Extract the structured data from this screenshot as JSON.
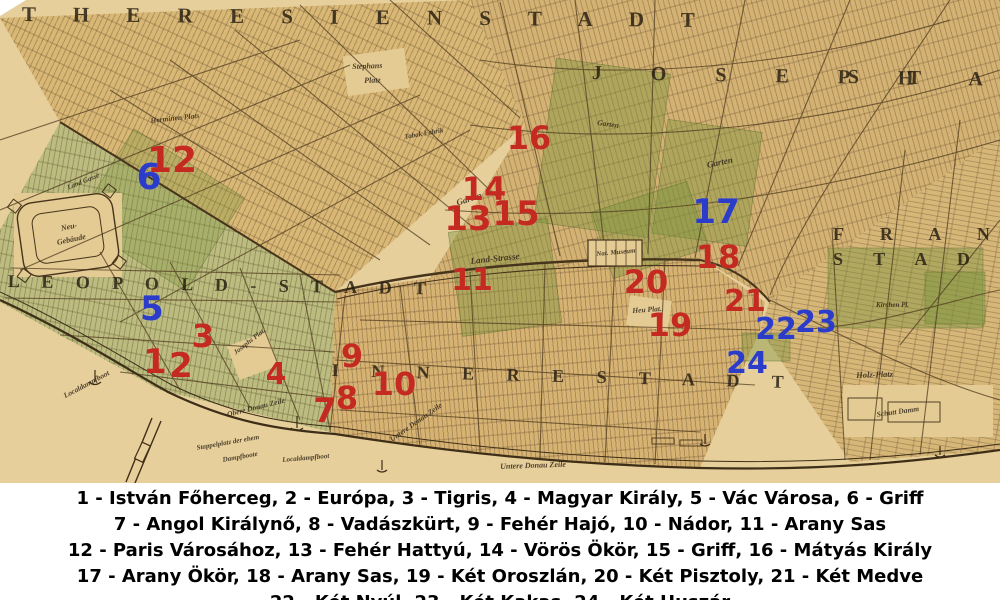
{
  "map": {
    "colors": {
      "marker_red": "#c42a20",
      "marker_blue": "#2b3cc9",
      "map_tan": "#d8b873",
      "river_tan": "#e6cf9b",
      "ink": "#2a2014"
    },
    "district_labels": [
      {
        "id": "theresienstadt",
        "text": "T H E R E S I E N S T A D T",
        "x": 22,
        "y": 2,
        "size": 21,
        "ls": 16,
        "rot": 0.5
      },
      {
        "id": "joseph",
        "text": "J O S E P H",
        "x": 592,
        "y": 62,
        "size": 20,
        "ls": 22,
        "rot": 1
      },
      {
        "id": "joseph-stadt",
        "text": "S T A D T",
        "x": 848,
        "y": 66,
        "size": 20,
        "ls": 22,
        "rot": 1
      },
      {
        "id": "leopold-stadt",
        "text": "L E O P O L D - S T A D T",
        "x": 8,
        "y": 271,
        "size": 18,
        "ls": 9,
        "rot": 1
      },
      {
        "id": "franz",
        "text": "F R A N Z",
        "x": 833,
        "y": 224,
        "size": 18,
        "ls": 16,
        "rot": 0
      },
      {
        "id": "franz-stadt",
        "text": "S T A D T",
        "x": 833,
        "y": 249,
        "size": 18,
        "ls": 13,
        "rot": 0
      },
      {
        "id": "innere-stadt",
        "text": "I N N E R E S T A D T",
        "x": 332,
        "y": 360,
        "size": 18,
        "ls": 14,
        "rot": 1.5
      }
    ],
    "street_labels": [
      {
        "text": "Stephans",
        "x": 352,
        "y": 62,
        "size": 8,
        "rot": -2
      },
      {
        "text": "Platz",
        "x": 364,
        "y": 76,
        "size": 8,
        "rot": -2
      },
      {
        "text": "Herminen Plats",
        "x": 150,
        "y": 116,
        "size": 7.5,
        "rot": -6
      },
      {
        "text": "Tabak Fabrik",
        "x": 404,
        "y": 133,
        "size": 7,
        "rot": -10
      },
      {
        "text": "Garten",
        "x": 455,
        "y": 198,
        "size": 9,
        "rot": -18
      },
      {
        "text": "Garten",
        "x": 706,
        "y": 160,
        "size": 9,
        "rot": -12
      },
      {
        "text": "Garten",
        "x": 598,
        "y": 118,
        "size": 7.5,
        "rot": 8
      },
      {
        "text": "Land-Strasse",
        "x": 470,
        "y": 256,
        "size": 9,
        "rot": -6
      },
      {
        "text": "Land Gasse",
        "x": 66,
        "y": 184,
        "size": 7,
        "rot": -22
      },
      {
        "text": "Neu-",
        "x": 60,
        "y": 224,
        "size": 8,
        "rot": -12
      },
      {
        "text": "Gebäude",
        "x": 56,
        "y": 238,
        "size": 8,
        "rot": -12
      },
      {
        "text": "Josephs Plat.",
        "x": 232,
        "y": 350,
        "size": 7,
        "rot": -38
      },
      {
        "text": "Heu Plat.",
        "x": 632,
        "y": 306,
        "size": 7.5,
        "rot": -4
      },
      {
        "text": "Nat. Museum",
        "x": 596,
        "y": 250,
        "size": 7,
        "rot": -5
      },
      {
        "text": "Kirchen Pl.",
        "x": 876,
        "y": 301,
        "size": 7,
        "rot": 0
      },
      {
        "text": "Holz-Platz",
        "x": 856,
        "y": 370,
        "size": 8.5,
        "rot": -2
      },
      {
        "text": "Schutt Damm",
        "x": 876,
        "y": 410,
        "size": 7.5,
        "rot": -8
      },
      {
        "text": "Untere Donau Zeile",
        "x": 500,
        "y": 462,
        "size": 8,
        "rot": -2
      },
      {
        "text": "Untere Donau Zeile",
        "x": 388,
        "y": 436,
        "size": 7.5,
        "rot": -35
      },
      {
        "text": "Obere Donau Zeile",
        "x": 226,
        "y": 410,
        "size": 7.5,
        "rot": -14
      },
      {
        "text": "Localdampfboot",
        "x": 62,
        "y": 392,
        "size": 7.5,
        "rot": -28
      },
      {
        "text": "Stappelplatz der ehem",
        "x": 196,
        "y": 444,
        "size": 7,
        "rot": -10
      },
      {
        "text": "Dampfboote",
        "x": 222,
        "y": 456,
        "size": 7,
        "rot": -10
      },
      {
        "text": "Localdampfboot",
        "x": 282,
        "y": 456,
        "size": 7,
        "rot": -5
      }
    ],
    "markers": [
      {
        "num": "1",
        "color": "red",
        "x": 155,
        "y": 362,
        "size": 34
      },
      {
        "num": "2",
        "color": "red",
        "x": 181,
        "y": 366,
        "size": 34
      },
      {
        "num": "3",
        "color": "red",
        "x": 203,
        "y": 336,
        "size": 32
      },
      {
        "num": "4",
        "color": "red",
        "x": 276,
        "y": 375,
        "size": 30
      },
      {
        "num": "5",
        "color": "blue",
        "x": 152,
        "y": 309,
        "size": 34
      },
      {
        "num": "6",
        "color": "blue",
        "x": 149,
        "y": 178,
        "size": 36
      },
      {
        "num": "7",
        "color": "red",
        "x": 325,
        "y": 411,
        "size": 34
      },
      {
        "num": "8",
        "color": "red",
        "x": 347,
        "y": 398,
        "size": 32
      },
      {
        "num": "9",
        "color": "red",
        "x": 352,
        "y": 356,
        "size": 32
      },
      {
        "num": "10",
        "color": "red",
        "x": 394,
        "y": 384,
        "size": 32
      },
      {
        "num": "11",
        "color": "red",
        "x": 472,
        "y": 281,
        "size": 30
      },
      {
        "num": "12",
        "color": "red",
        "x": 172,
        "y": 161,
        "size": 36
      },
      {
        "num": "13",
        "color": "red",
        "x": 468,
        "y": 219,
        "size": 34
      },
      {
        "num": "14",
        "color": "red",
        "x": 484,
        "y": 189,
        "size": 32
      },
      {
        "num": "15",
        "color": "red",
        "x": 516,
        "y": 214,
        "size": 34
      },
      {
        "num": "16",
        "color": "red",
        "x": 529,
        "y": 138,
        "size": 32
      },
      {
        "num": "17",
        "color": "blue",
        "x": 716,
        "y": 212,
        "size": 34
      },
      {
        "num": "18",
        "color": "red",
        "x": 718,
        "y": 257,
        "size": 32
      },
      {
        "num": "19",
        "color": "red",
        "x": 670,
        "y": 325,
        "size": 32
      },
      {
        "num": "20",
        "color": "red",
        "x": 646,
        "y": 282,
        "size": 32
      },
      {
        "num": "21",
        "color": "red",
        "x": 745,
        "y": 302,
        "size": 30
      },
      {
        "num": "22",
        "color": "blue",
        "x": 776,
        "y": 330,
        "size": 30
      },
      {
        "num": "23",
        "color": "blue",
        "x": 816,
        "y": 323,
        "size": 30
      },
      {
        "num": "24",
        "color": "blue",
        "x": 747,
        "y": 364,
        "size": 30
      }
    ]
  },
  "legend": {
    "lines": [
      "1 - István Főherceg, 2 - Európa, 3 - Tigris, 4 - Magyar Király, 5 - Vác Városa, 6 - Griff",
      "7 - Angol Királynő, 8 - Vadászkürt, 9 - Fehér Hajó, 10 - Nádor, 11 - Arany Sas",
      "12 - Paris Városához, 13 - Fehér Hattyú, 14 - Vörös Ökör, 15 - Griff, 16 - Mátyás Király",
      "17 - Arany Ökör, 18 - Arany Sas, 19 - Két Oroszlán, 20 - Két Pisztoly, 21 - Két Medve",
      "22 - Két Nyúl, 23 - Két Kakas, 24 - Két Huszár"
    ]
  }
}
